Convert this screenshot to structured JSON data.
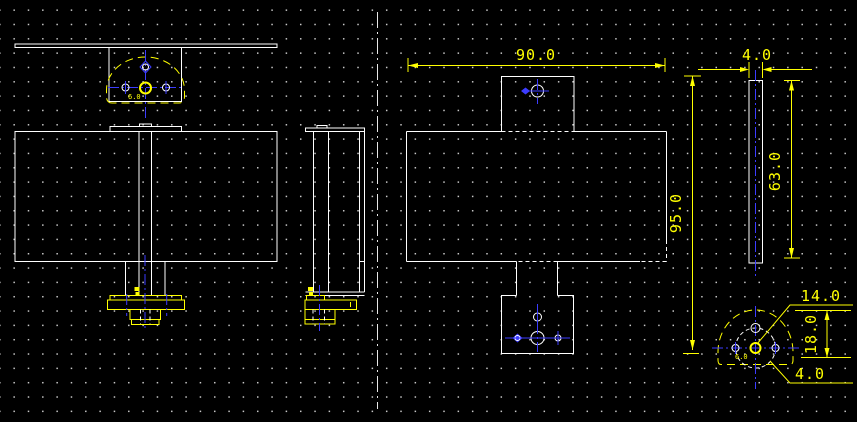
{
  "app": {
    "type": "cad-drawing-viewport",
    "background": "#000000"
  },
  "colors": {
    "geometry": "#ffffff",
    "dimension": "#ffff00",
    "centerline": "#3c3cff",
    "grid_dot": "#c8c8c8"
  },
  "dimensions": {
    "plan_width": "90.0",
    "bar_thickness": "4.0",
    "overall_height": "95.0",
    "bar_length": "63.0",
    "bolt_circle": "14.0",
    "head_height": "18.0",
    "hole_diameter": "4.0",
    "center_hole_front": "6.0",
    "center_hole_bottom": "6.0"
  }
}
